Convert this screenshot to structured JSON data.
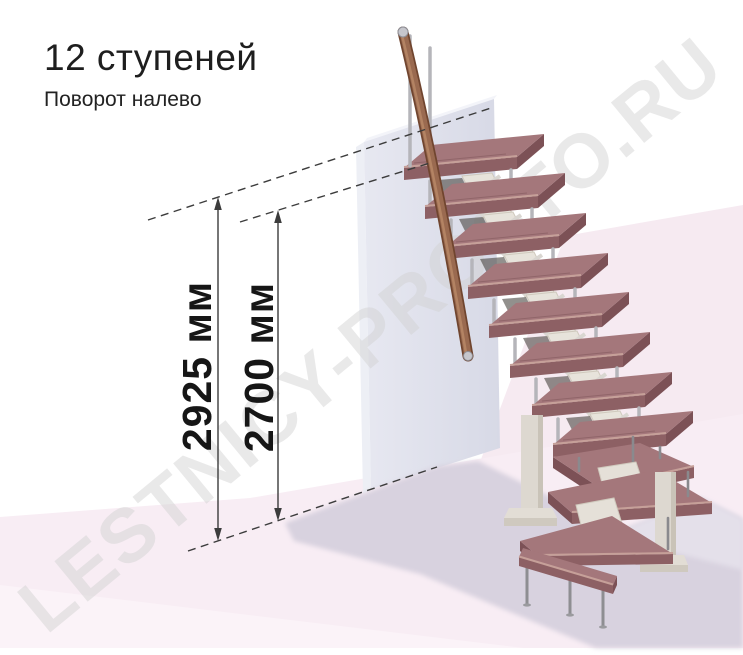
{
  "header": {
    "title": "12 ступеней",
    "subtitle": "Поворот налево"
  },
  "watermark": {
    "text": "LESTNICY-PROSTO.RU"
  },
  "stair": {
    "steps_count": 12,
    "turn_direction": "налево",
    "straight_steps": 8,
    "winder_steps": 3,
    "bottom_steps": 1
  },
  "dimensions": {
    "lines": [
      {
        "id": "total-height",
        "label": "2925 мм",
        "value": 2925,
        "unit": "мм"
      },
      {
        "id": "flight-height",
        "label": "2700 мм",
        "value": 2700,
        "unit": "мм"
      }
    ]
  },
  "colors": {
    "tread_top": "#a4777b",
    "tread_front": "#8d6064",
    "tread_side": "#7c5156",
    "handrail": "#96664f",
    "metal_baluster": "#b5b5ba",
    "stringer": "#e7e3db",
    "wall": "#dfe1ec",
    "floor": "#f8edf4",
    "shadow": "#d8d2df",
    "dimension_line": "#3c3c3c",
    "watermark": "#d2d2d2"
  }
}
